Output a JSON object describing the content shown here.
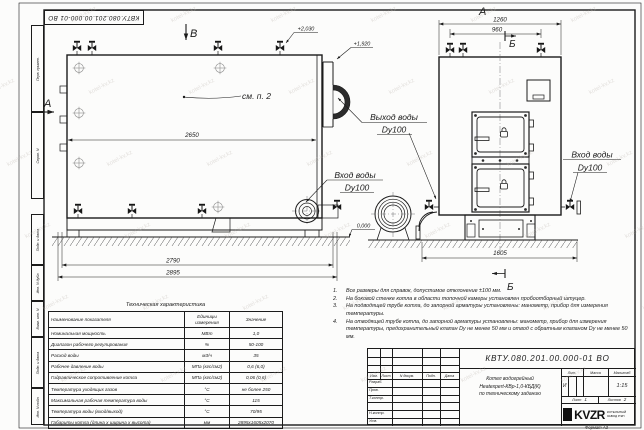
{
  "watermark": {
    "text": "kotel-kv.kz",
    "color": "#b5ada6"
  },
  "frame": {
    "designation_inverted": "КВТУ.080.201.00.000-01 ВО",
    "left_boxes": [
      {
        "label": "Перв. примен."
      },
      {
        "label": "Справ. N"
      },
      {
        "label": "Подп. и дата"
      },
      {
        "label": "Инв. N дубл."
      },
      {
        "label": "Взам. инв. N"
      },
      {
        "label": "Подп. и дата"
      },
      {
        "label": "Инв. N подл."
      }
    ]
  },
  "drawing": {
    "view_labels": {
      "v": "В",
      "a_side": "А",
      "a_top": "А",
      "b_top": "Б",
      "b_bottom": "Б"
    },
    "elevations": {
      "top": "+2,030",
      "duct": "+1,920",
      "ground": "0,000"
    },
    "dimensions": {
      "side_length": "2650",
      "side_base": "2790",
      "side_overall": "2895",
      "front_width": "1260",
      "front_valves": "960",
      "front_base": "1605"
    },
    "callouts": {
      "see_note": "см. п. 2",
      "outlet_line1": "Выход воды",
      "outlet_line2": "Dy100",
      "inlet_side_line1": "Вход воды",
      "inlet_side_line2": "Dy100",
      "inlet_front_line1": "Вход воды",
      "inlet_front_line2": "Dy100"
    }
  },
  "notes": {
    "items": [
      {
        "n": "1.",
        "text": "Все размеры для справок, допустимое отклонение ±100 мм."
      },
      {
        "n": "2.",
        "text": "На боковой стенке котла в области топочной камеры установлен пробоотборный штуцер."
      },
      {
        "n": "3.",
        "text": "На подводящей трубе котла, до запорной арматуры установлены: манометр, прибор для измерения температуры."
      },
      {
        "n": "4.",
        "text": "На отводящей трубе котла, до запорной арматуры установлены: манометр, прибор для измерения температуры, предохранительный клапан Dу не менее 50 мм и отвод с обратным клапаном Dу не менее 50 мм."
      }
    ]
  },
  "table": {
    "title": "Техническая характеристика",
    "headers": {
      "name": "Наименование показателя",
      "unit": "Единицы измерения",
      "value": "Значение"
    },
    "rows": [
      {
        "name": "Номинальная мощность",
        "unit": "МВт",
        "value": "1,0"
      },
      {
        "name": "Диапазон рабочего регулирования",
        "unit": "%",
        "value": "50-100"
      },
      {
        "name": "Расход воды",
        "unit": "м3/ч",
        "value": "35"
      },
      {
        "name": "Рабочее давление воды",
        "unit": "МПа (кгс/см2)",
        "value": "0,6 (6,0)"
      },
      {
        "name": "Гидравлическое сопротивление котла",
        "unit": "МПа (кгс/см2)",
        "value": "0,06 (0,6)"
      },
      {
        "name": "Температура уходящих газов",
        "unit": "°С",
        "value": "не более 250"
      },
      {
        "name": "Максимальная рабочая температура воды",
        "unit": "°С",
        "value": "115"
      },
      {
        "name": "Температура воды (вход/выход)",
        "unit": "°С",
        "value": "70/95"
      },
      {
        "name": "Габариты котла (длина х ширина х высота)",
        "unit": "мм",
        "value": "2895х1605х2070"
      }
    ]
  },
  "stamp": {
    "designation": "КВТУ.080.201.00.000-01 ВО",
    "title_line1": "Котел водогрейный",
    "title_line2": "Heatexpert-КВр-1,0-КБД(К)",
    "title_line3": "по техническому заданию",
    "col_izm": "Изм.",
    "col_list": "Лист",
    "col_dokum": "N докум.",
    "col_podp": "Подп.",
    "col_data": "Дата",
    "row_razrab": "Разраб.",
    "row_prov": "Пров.",
    "row_tkontr": "Т.контр.",
    "row_nkontr": "Н.контр.",
    "row_utv": "Утв.",
    "lit_header": "Лит.",
    "massa_header": "Масса",
    "scale_header": "Масштаб",
    "lit_value": "И",
    "scale_value": "1:15",
    "sheet_label": "Лист",
    "sheet_value": "1",
    "sheets_label": "Листов",
    "sheets_value": "2",
    "logo_text": "KVZR",
    "logo_caption": "КОТЕЛЬНЫЙ ЗАВОД РЭП",
    "format_label": "Формат  А3"
  }
}
